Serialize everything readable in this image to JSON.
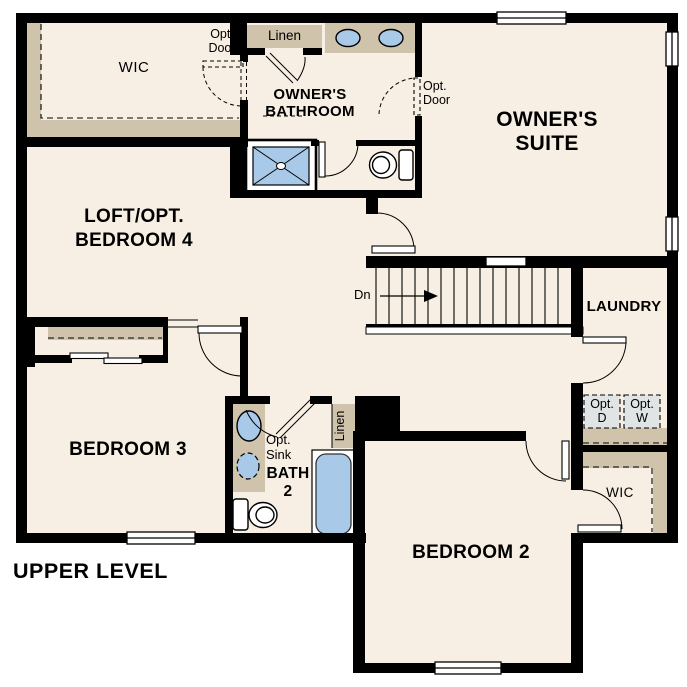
{
  "title": "UPPER LEVEL",
  "colors": {
    "canvas": "#ffffff",
    "floor": "#f8efe4",
    "wall": "#000000",
    "shelf_tan": "#cfc3ab",
    "fixture_blue": "#a9c9e8",
    "appliance_gray": "#e0e4e5"
  },
  "rooms": {
    "wic_owner": {
      "label": "WIC"
    },
    "owners_bathroom": {
      "line1": "OWNER'S",
      "line2": "BATHROOM"
    },
    "owners_suite": {
      "line1": "OWNER'S",
      "line2": "SUITE"
    },
    "loft": {
      "line1": "LOFT/OPT.",
      "line2": "BEDROOM 4"
    },
    "laundry": {
      "label": "LAUNDRY"
    },
    "bedroom3": {
      "label": "BEDROOM 3"
    },
    "bedroom2": {
      "label": "BEDROOM 2"
    },
    "bath2": {
      "line1": "BATH",
      "line2": "2"
    },
    "wic_bedroom2": {
      "label": "WIC"
    }
  },
  "closets": {
    "linen_owner": {
      "label": "Linen"
    },
    "linen_bath2": {
      "label": "Linen"
    }
  },
  "annotations": {
    "opt_door_wic": {
      "line1": "Opt.",
      "line2": "Door"
    },
    "opt_door_suite": {
      "line1": "Opt.",
      "line2": "Door"
    },
    "opt_sink": {
      "line1": "Opt.",
      "line2": "Sink"
    },
    "opt_dryer": {
      "line1": "Opt.",
      "line2": "D"
    },
    "opt_washer": {
      "line1": "Opt.",
      "line2": "W"
    },
    "stair_direction": {
      "label": "Dn"
    }
  }
}
